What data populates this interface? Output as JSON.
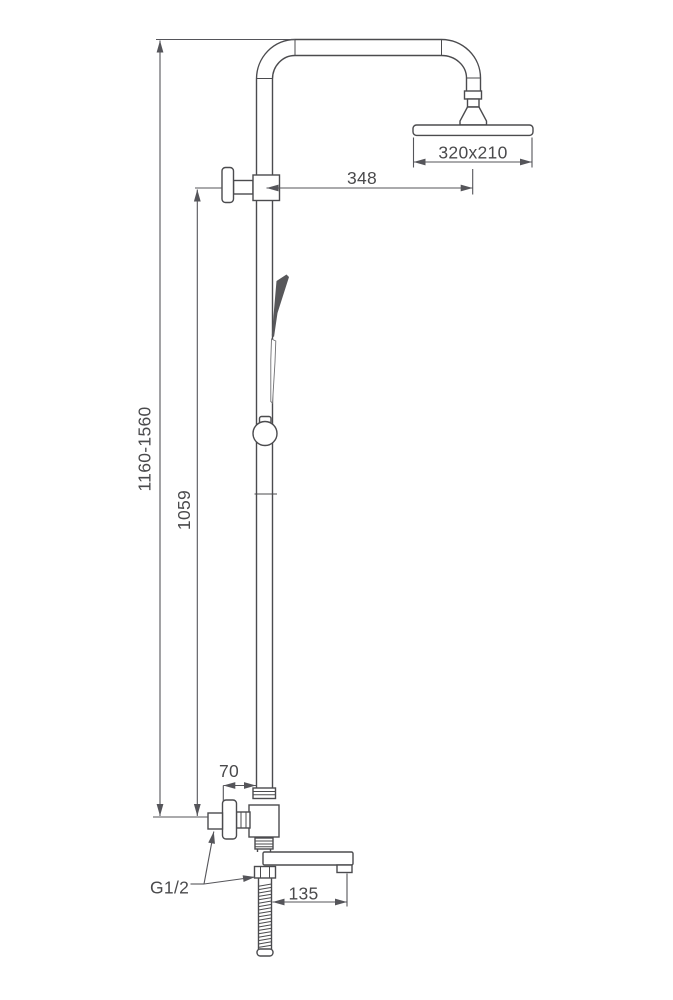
{
  "drawing": {
    "type": "technical-dimension-drawing",
    "subject": "exposed thermostatic shower column with overhead shower, hand shower, mixer valve and tub spout",
    "colors": {
      "background": "#ffffff",
      "line": "#4b4b4e",
      "hand_shower_fill": "#57575a"
    },
    "dimensions": {
      "overall_height": "1160-1560",
      "inlet_to_diverter": "1059",
      "arm_reach": "348",
      "head_size": "320x210",
      "wall_to_riser": "70",
      "spout_reach": "135",
      "thread_size": "G1/2"
    }
  }
}
